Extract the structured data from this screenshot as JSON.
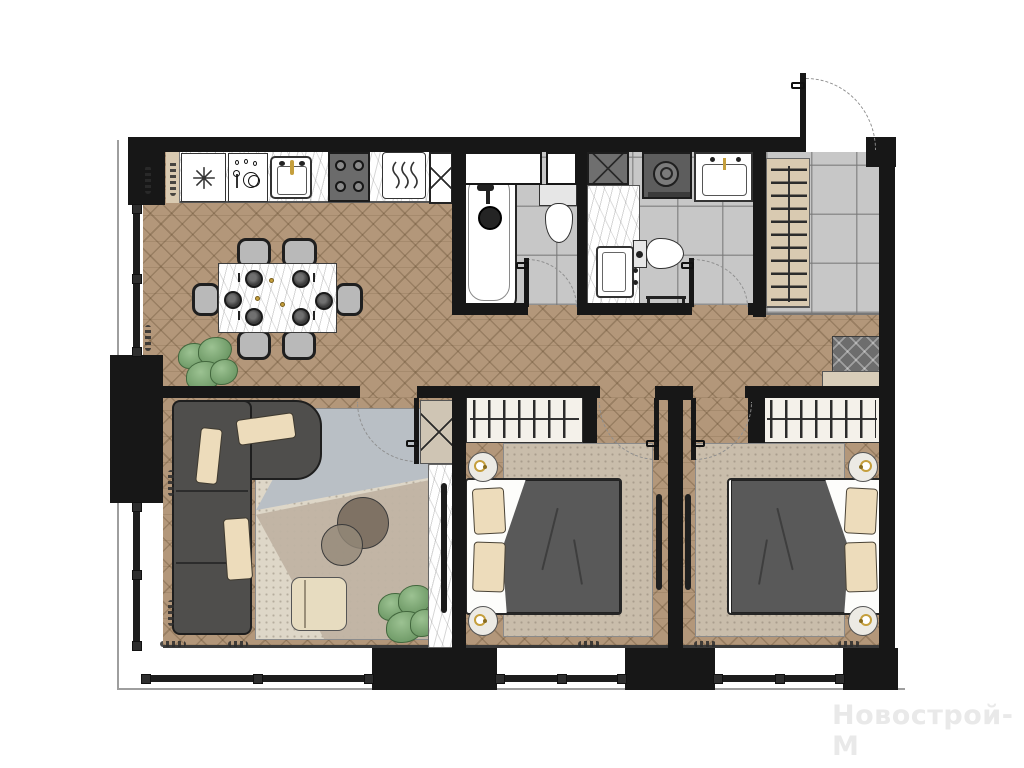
{
  "watermark": {
    "text": "Новострой-М"
  },
  "palette": {
    "wall": "#171717",
    "wood": "#b3977a",
    "tile": "#c7c7c7",
    "sofa": "#4f4e4c",
    "blanket": "#595959",
    "pillow": "#eddcbb",
    "rug_living": "#ded7c8",
    "rug_blue": "#b9bfc5",
    "rug_taupe": "#c0b3a3",
    "rug_bedroom": "#c9bdab",
    "closet": "#d9cab1",
    "doormat": "#6d6d6d",
    "gold": "#c59f3d",
    "appliance": "#6b6b6b",
    "arc": "#8f8f8f",
    "facade": "#9e9e9e",
    "watermark": "#e9e9e9",
    "plant_dark": "#5d8a56",
    "plant_light": "#9cc292"
  },
  "icons": [
    "snowflake-fridge-icon",
    "dishwasher-icon",
    "kitchen-sink-faucet-icon",
    "stove-burners-icon",
    "oven-steam-icon",
    "ventilation-shaft-x-icon",
    "washing-machine-icon",
    "bathroom-sink-icon",
    "toilet-icon",
    "bathtub-icon",
    "shower-head-icon",
    "hanger-rail-icon",
    "door-swing-arc",
    "window-bar",
    "place-setting-icon",
    "table-lamp-icon",
    "tv-icon",
    "doormat-icon",
    "plant-icon"
  ]
}
